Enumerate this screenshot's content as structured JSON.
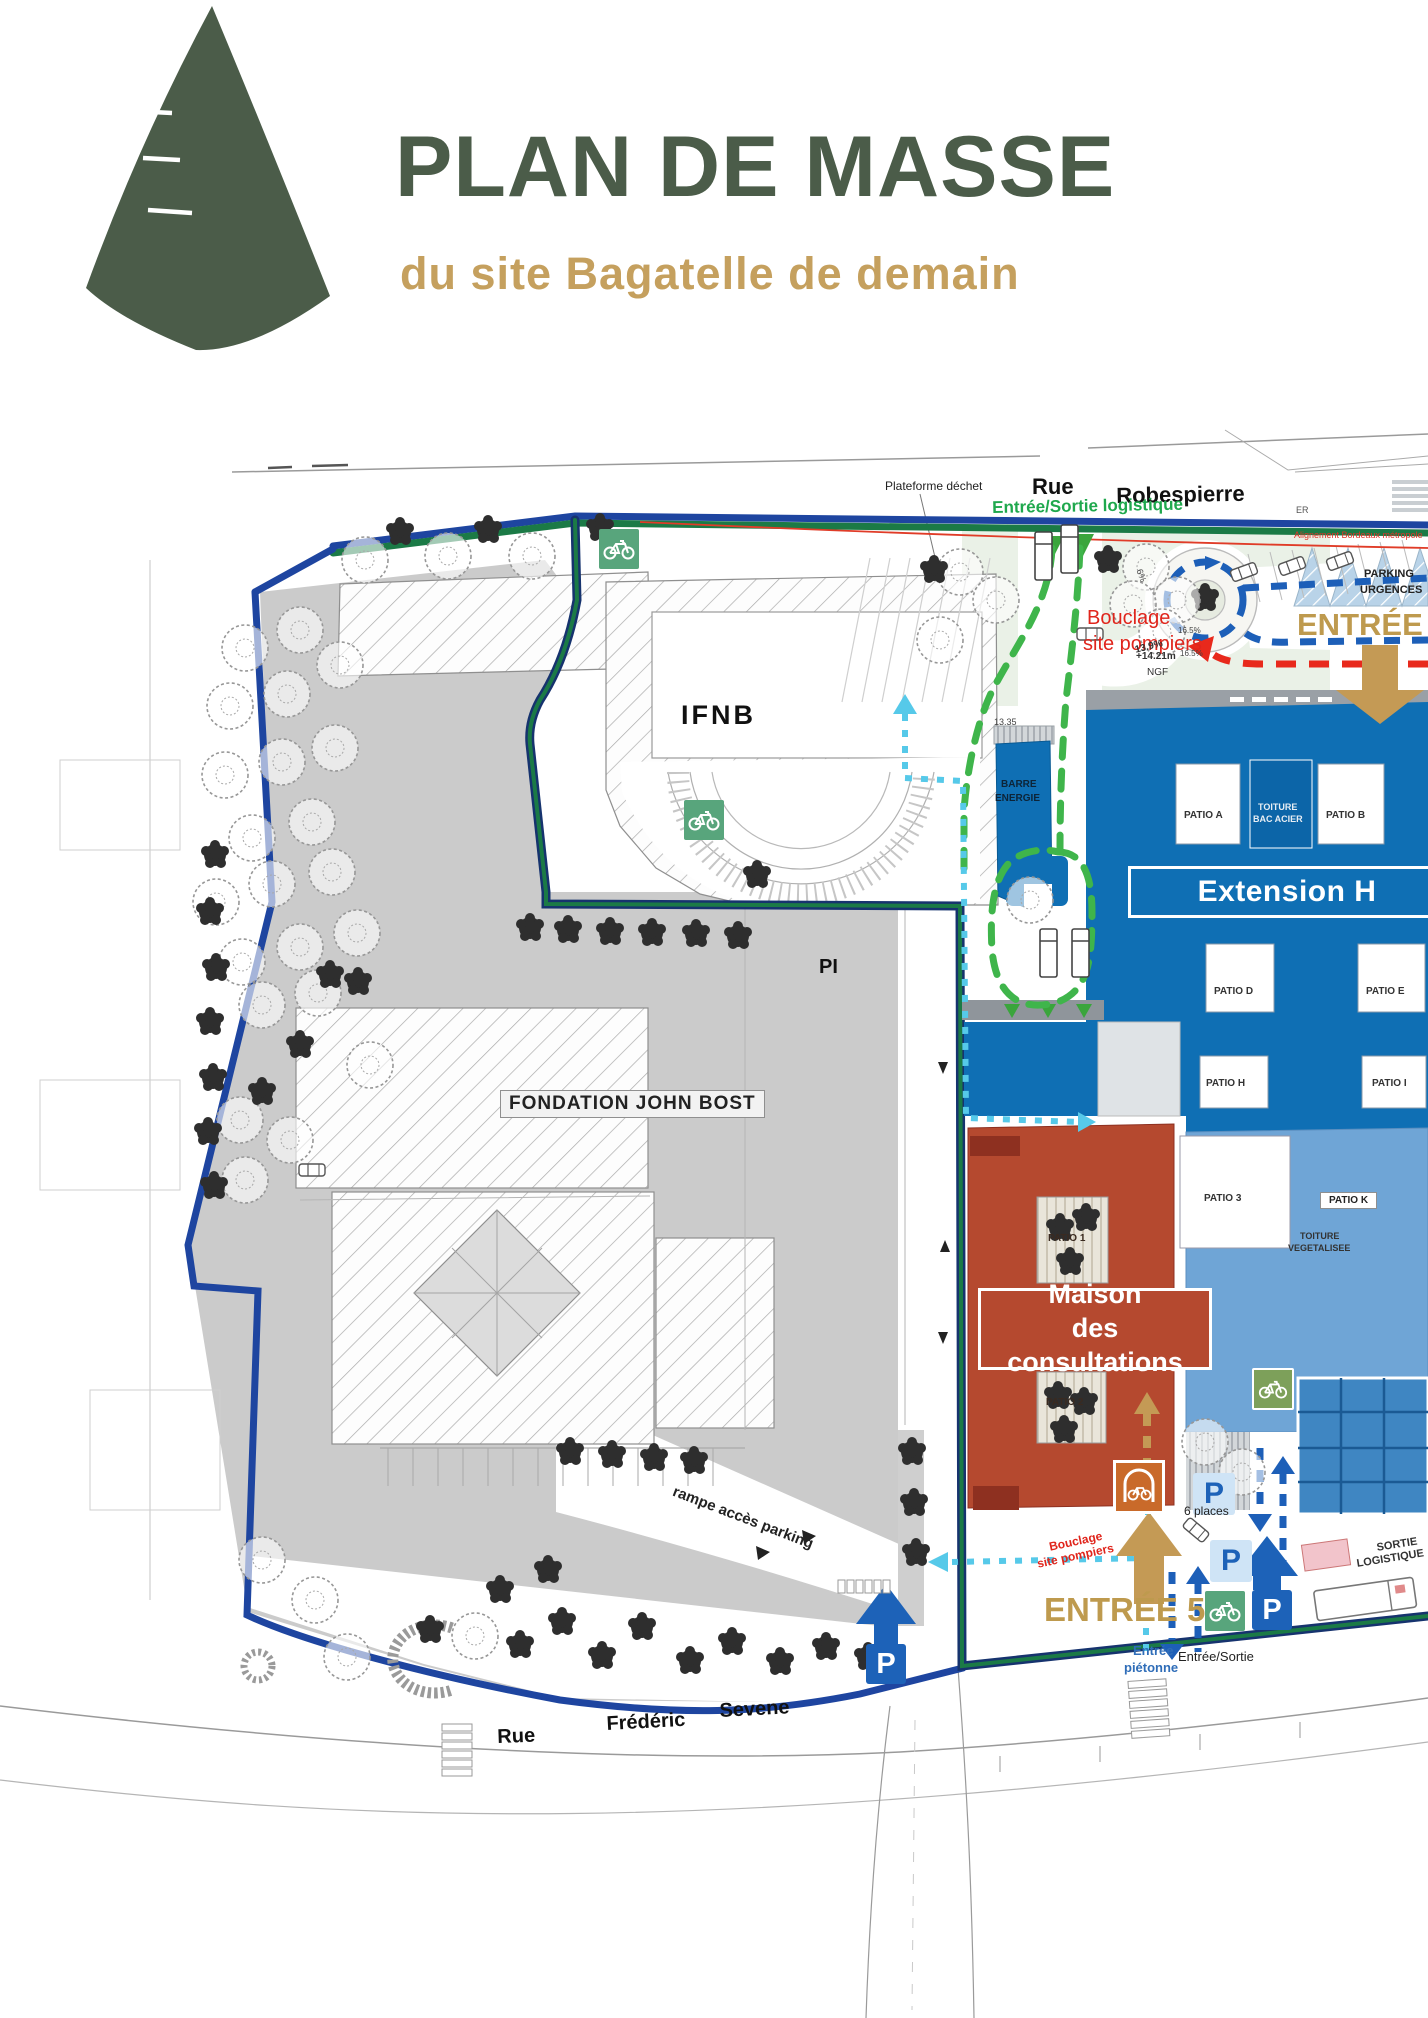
{
  "header": {
    "title": "PLAN DE MASSE",
    "subtitle": "du site Bagatelle de demain"
  },
  "colors": {
    "brand_green": "#4b5c49",
    "brand_tan": "#c5a05e",
    "boundary_blue": "#1e45a0",
    "boundary_green": "#1b7a46",
    "hospital_blue": "#0f6fb4",
    "light_blue_building": "#6fa5d6",
    "red_building": "#b5492f",
    "fire_loop_green": "#3fb54b",
    "pedestrian_cyan": "#56c9e9",
    "route_red": "#e8291c",
    "route_blue": "#1d5fb8",
    "entrance_tan": "#be9a4e",
    "bike_green": "#58a57c"
  },
  "icons": {
    "p_label": "P",
    "names": [
      "parking-icon",
      "bike-parking-icon",
      "covered-bike-parking-icon",
      "entrance-arrow",
      "logistics-triangle"
    ]
  },
  "callouts": {
    "extension": "Extension H",
    "maison_line1": "Maison",
    "maison_line2": "des consultations",
    "fondation": "FONDATION JOHN BOST",
    "patio_k": "PATIO K"
  },
  "map_labels": [
    {
      "name": "plateforme-dechet-label",
      "text": "Plateforme déchet",
      "x": 885,
      "y": 480,
      "fs": 12,
      "c": "#222",
      "w": 400,
      "r": 0
    },
    {
      "name": "street-rue-robespierre-rue",
      "text": "Rue",
      "x": 1032,
      "y": 475,
      "fs": 22,
      "c": "#111",
      "w": 700,
      "r": 0
    },
    {
      "name": "street-rue-robespierre-name",
      "text": "Robespierre",
      "x": 1116,
      "y": 484,
      "fs": 22,
      "c": "#111",
      "w": 700,
      "r": -1
    },
    {
      "name": "er-label",
      "text": "ER",
      "x": 1296,
      "y": 506,
      "fs": 9,
      "c": "#555",
      "w": 400,
      "r": 0
    },
    {
      "name": "entree-sortie-logistique-label",
      "text": "Entrée/Sortie logistique",
      "x": 992,
      "y": 499,
      "fs": 17,
      "c": "#1fa84d",
      "w": 700,
      "r": -1
    },
    {
      "name": "alignement-label",
      "text": "Alignement Bordeaux métropole",
      "x": 1294,
      "y": 531,
      "fs": 9,
      "c": "#e03428",
      "w": 400,
      "r": 0
    },
    {
      "name": "bouclage-pompiers-line1",
      "text": "Bouclage",
      "x": 1087,
      "y": 608,
      "fs": 20,
      "c": "#e0251c",
      "w": 400,
      "r": 0
    },
    {
      "name": "bouclage-pompiers-line2",
      "text": "site pompiers",
      "x": 1083,
      "y": 634,
      "fs": 20,
      "c": "#e0251c",
      "w": 400,
      "r": 0
    },
    {
      "name": "ngf-elevation-line1",
      "text": "+14.21m",
      "x": 1136,
      "y": 652,
      "fs": 10,
      "c": "#333",
      "w": 700,
      "r": 0
    },
    {
      "name": "ngf-elevation-line2",
      "text": "NGF",
      "x": 1147,
      "y": 668,
      "fs": 10,
      "c": "#333",
      "w": 400,
      "r": 0
    },
    {
      "name": "slope-6pct",
      "text": "6%",
      "x": 1143,
      "y": 568,
      "fs": 9,
      "c": "#444",
      "w": 400,
      "r": 70
    },
    {
      "name": "slope-165a",
      "text": "16.5%",
      "x": 1178,
      "y": 627,
      "fs": 8,
      "c": "#444",
      "w": 400,
      "r": 0
    },
    {
      "name": "slope-139",
      "text": "13.9%",
      "x": 1134,
      "y": 646,
      "fs": 10,
      "c": "#333",
      "w": 600,
      "r": -14
    },
    {
      "name": "slope-165b",
      "text": "16.5%",
      "x": 1180,
      "y": 650,
      "fs": 8,
      "c": "#444",
      "w": 400,
      "r": 0
    },
    {
      "name": "entree-1-label",
      "text": "ENTRÉE",
      "x": 1297,
      "y": 608,
      "fs": 31,
      "c": "#be9a4e",
      "w": 800,
      "r": 0
    },
    {
      "name": "parking-urgences-line1",
      "text": "PARKING",
      "x": 1364,
      "y": 569,
      "fs": 11,
      "c": "#222",
      "w": 700,
      "r": 0
    },
    {
      "name": "parking-urgences-line2",
      "text": "URGENCES",
      "x": 1360,
      "y": 585,
      "fs": 11,
      "c": "#222",
      "w": 700,
      "r": 0
    },
    {
      "name": "ifnb-label",
      "text": "IFNB",
      "x": 681,
      "y": 701,
      "fs": 27,
      "c": "#111",
      "w": 600,
      "r": 0,
      "ls": 3
    },
    {
      "name": "barre-energie-line1",
      "text": "BARRE",
      "x": 1001,
      "y": 780,
      "fs": 10,
      "c": "#0d2438",
      "w": 600,
      "r": 0
    },
    {
      "name": "barre-energie-line2",
      "text": "ENERGIE",
      "x": 995,
      "y": 794,
      "fs": 10,
      "c": "#0d2438",
      "w": 600,
      "r": 0
    },
    {
      "name": "patio-a-label",
      "text": "PATIO A",
      "x": 1184,
      "y": 811,
      "fs": 10,
      "c": "#333",
      "w": 600,
      "r": 0
    },
    {
      "name": "toiture-bac-acier-line1",
      "text": "TOITURE",
      "x": 1258,
      "y": 803,
      "fs": 9,
      "c": "#e8eef4",
      "w": 600,
      "r": 0
    },
    {
      "name": "toiture-bac-acier-line2",
      "text": "BAC ACIER",
      "x": 1253,
      "y": 815,
      "fs": 9,
      "c": "#e8eef4",
      "w": 600,
      "r": 0
    },
    {
      "name": "patio-b-label",
      "text": "PATIO B",
      "x": 1326,
      "y": 811,
      "fs": 10,
      "c": "#333",
      "w": 600,
      "r": 0
    },
    {
      "name": "patio-d-label",
      "text": "PATIO D",
      "x": 1214,
      "y": 987,
      "fs": 10,
      "c": "#333",
      "w": 600,
      "r": 0
    },
    {
      "name": "patio-e-label",
      "text": "PATIO E",
      "x": 1366,
      "y": 987,
      "fs": 10,
      "c": "#333",
      "w": 600,
      "r": 0
    },
    {
      "name": "patio-h-label",
      "text": "PATIO H",
      "x": 1206,
      "y": 1079,
      "fs": 10,
      "c": "#333",
      "w": 600,
      "r": 0
    },
    {
      "name": "patio-i-label",
      "text": "PATIO I",
      "x": 1372,
      "y": 1079,
      "fs": 10,
      "c": "#333",
      "w": 600,
      "r": 0
    },
    {
      "name": "pi-label",
      "text": "PI",
      "x": 819,
      "y": 957,
      "fs": 20,
      "c": "#111",
      "w": 700,
      "r": 0
    },
    {
      "name": "level-1335",
      "text": "13.35",
      "x": 994,
      "y": 718,
      "fs": 9,
      "c": "#444",
      "w": 400,
      "r": 0
    },
    {
      "name": "patio-3-label",
      "text": "PATIO 3",
      "x": 1204,
      "y": 1194,
      "fs": 10,
      "c": "#333",
      "w": 600,
      "r": 0
    },
    {
      "name": "toiture-vegetalisee-line1",
      "text": "TOITURE",
      "x": 1300,
      "y": 1232,
      "fs": 9,
      "c": "#333",
      "w": 600,
      "r": 0
    },
    {
      "name": "toiture-vegetalisee-line2",
      "text": "VEGETALISEE",
      "x": 1288,
      "y": 1244,
      "fs": 9,
      "c": "#333",
      "w": 600,
      "r": 0
    },
    {
      "name": "patio-1-label",
      "text": "PATIO 1",
      "x": 1048,
      "y": 1234,
      "fs": 10,
      "c": "#3a2a20",
      "w": 600,
      "r": 0
    },
    {
      "name": "patio-2-label",
      "text": "PATIO 2",
      "x": 1046,
      "y": 1398,
      "fs": 10,
      "c": "#3a2a20",
      "w": 600,
      "r": 0
    },
    {
      "name": "six-places-label",
      "text": "6 places",
      "x": 1184,
      "y": 1505,
      "fs": 12,
      "c": "#222",
      "w": 400,
      "r": 0
    },
    {
      "name": "bouclage-small-line1",
      "text": "Bouclage",
      "x": 1048,
      "y": 1541,
      "fs": 12,
      "c": "#e0251c",
      "w": 600,
      "r": -12
    },
    {
      "name": "bouclage-small-line2",
      "text": "site pompiers",
      "x": 1036,
      "y": 1558,
      "fs": 12,
      "c": "#e0251c",
      "w": 600,
      "r": -12
    },
    {
      "name": "entree-5-label",
      "text": "ENTRÉE 5",
      "x": 1044,
      "y": 1592,
      "fs": 33,
      "c": "#be9a4e",
      "w": 800,
      "r": 0
    },
    {
      "name": "entree-pietonne-line1",
      "text": "Entrée",
      "x": 1133,
      "y": 1644,
      "fs": 13,
      "c": "#2f6db8",
      "w": 600,
      "r": 0
    },
    {
      "name": "entree-pietonne-line2",
      "text": "piétonne",
      "x": 1124,
      "y": 1661,
      "fs": 13,
      "c": "#2f6db8",
      "w": 600,
      "r": 0
    },
    {
      "name": "entree-sortie-label",
      "text": "Entrée/Sortie",
      "x": 1178,
      "y": 1650,
      "fs": 13,
      "c": "#222",
      "w": 400,
      "r": 0
    },
    {
      "name": "sortie-logistique-line1",
      "text": "SORTIE",
      "x": 1376,
      "y": 1543,
      "fs": 11,
      "c": "#333",
      "w": 600,
      "r": -9
    },
    {
      "name": "sortie-logistique-line2",
      "text": "LOGISTIQUE",
      "x": 1356,
      "y": 1559,
      "fs": 11,
      "c": "#333",
      "w": 600,
      "r": -9
    },
    {
      "name": "rampe-acces-parking-label",
      "text": "rampe accès parking",
      "x": 676,
      "y": 1484,
      "fs": 15,
      "c": "#222",
      "w": 600,
      "r": 21
    },
    {
      "name": "street-rue-frederic-rue",
      "text": "Rue",
      "x": 497,
      "y": 1727,
      "fs": 20,
      "c": "#111",
      "w": 700,
      "r": -2
    },
    {
      "name": "street-rue-frederic-frederic",
      "text": "Frédéric",
      "x": 606,
      "y": 1714,
      "fs": 20,
      "c": "#111",
      "w": 700,
      "r": -3
    },
    {
      "name": "street-rue-frederic-sevene",
      "text": "Sevene",
      "x": 719,
      "y": 1701,
      "fs": 20,
      "c": "#111",
      "w": 700,
      "r": -3
    }
  ]
}
